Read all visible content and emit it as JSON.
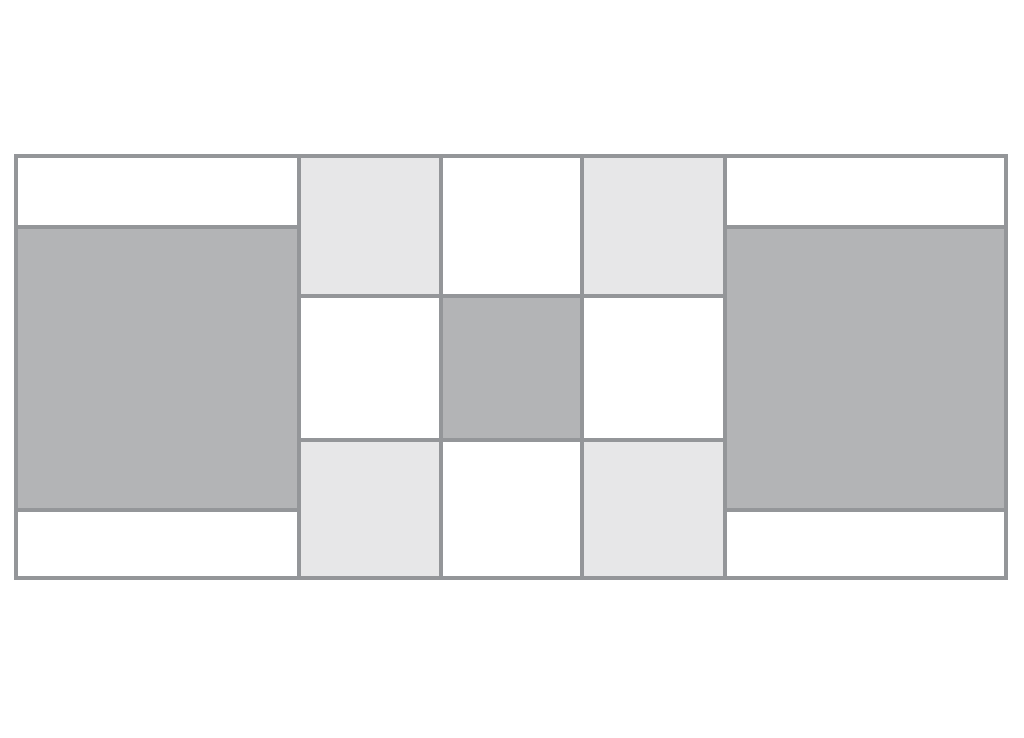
{
  "figure": {
    "kind": "tile-pattern-diagram",
    "background_color": "#ffffff",
    "border_color": "#949699",
    "fills": {
      "white": "#ffffff",
      "light": "#e7e7e8",
      "dark": "#b3b4b6"
    },
    "cells": {
      "left_top_strip": "white",
      "left_block": "dark",
      "left_bottom_strip": "white",
      "grid_r1c1": "light",
      "grid_r1c2": "white",
      "grid_r1c3": "light",
      "grid_r2c1": "white",
      "grid_r2c2": "dark",
      "grid_r2c3": "white",
      "grid_r3c1": "light",
      "grid_r3c2": "white",
      "grid_r3c3": "light",
      "right_top_strip": "white",
      "right_block": "dark",
      "right_bottom_strip": "white"
    }
  }
}
